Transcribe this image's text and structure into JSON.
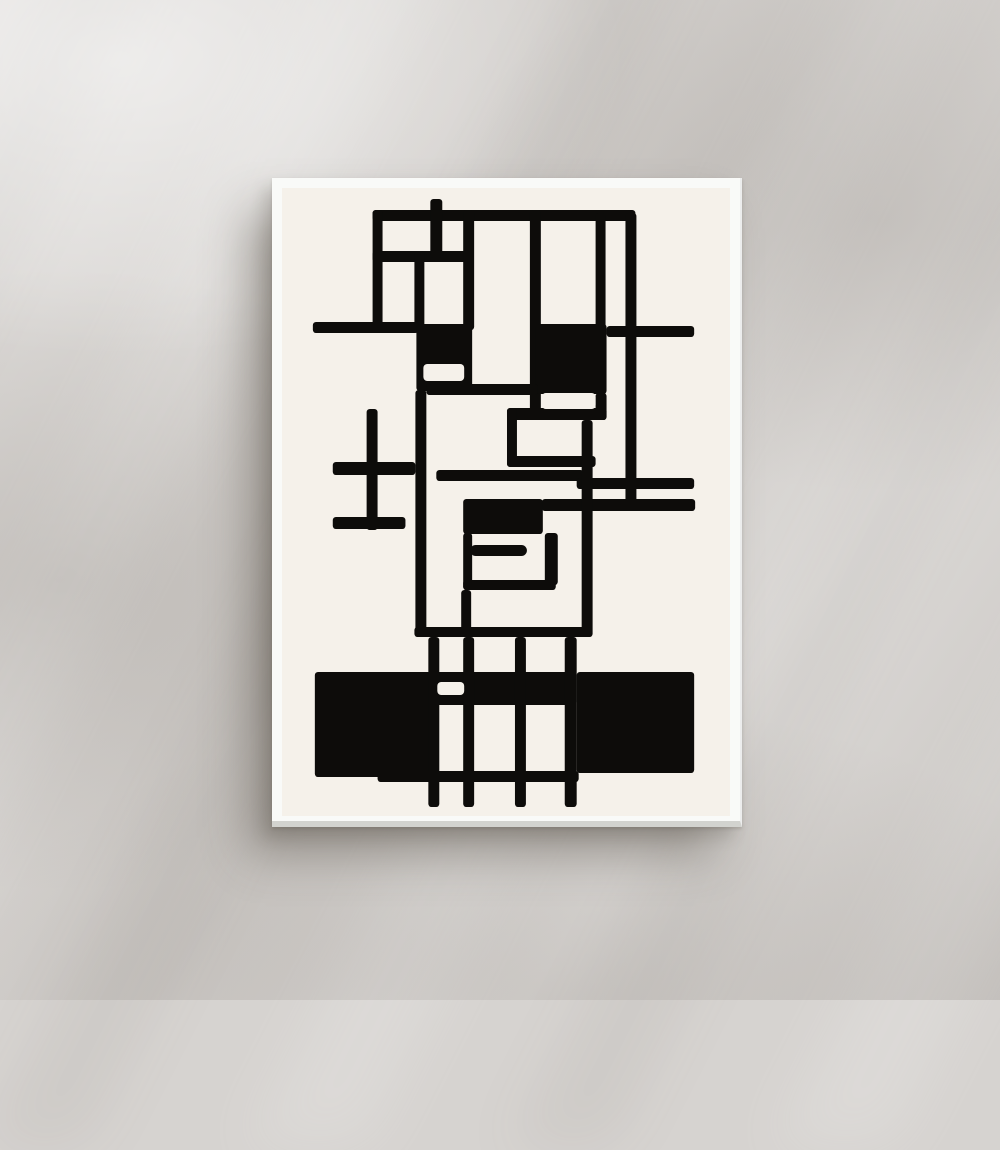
{
  "scene": {
    "description": "White framed poster with abstract black geometric line art on cream paper, hanging on a bright wall with soft diagonal window-light shadows",
    "colors": {
      "wall": "#d6d3d0",
      "wall_highlight": "#e7e5e2",
      "wall_shade": "#c7c3c0",
      "frame": "#f9faf8",
      "frame_edge": "#d2d3cf",
      "paper": "#f5f1ea",
      "ink": "#0d0c0a"
    }
  },
  "poster": {
    "left": 272,
    "top": 178,
    "width": 470,
    "height": 649,
    "paper_inset": 10
  },
  "artwork": {
    "title": "Abstract geometric black line composition on cream",
    "viewBox": "282 188 450 628",
    "line_radius": 3.2,
    "notch_radius": 4,
    "stub_radius": 5.5,
    "black_shapes": [
      [
        373,
        210,
        264,
        11
      ],
      [
        431,
        199,
        12,
        14
      ],
      [
        373,
        210,
        10,
        122
      ],
      [
        373,
        251,
        101,
        11
      ],
      [
        431,
        210,
        12,
        48
      ],
      [
        415,
        251,
        10,
        80
      ],
      [
        464,
        210,
        11,
        120
      ],
      [
        531,
        210,
        11,
        210
      ],
      [
        597,
        213,
        10,
        115
      ],
      [
        627,
        213,
        11,
        296
      ],
      [
        313,
        322,
        106,
        11
      ],
      [
        417,
        324,
        56,
        67
      ],
      [
        537,
        324,
        71,
        70
      ],
      [
        608,
        326,
        88,
        11
      ],
      [
        427,
        384,
        112,
        11
      ],
      [
        597,
        393,
        11,
        27
      ],
      [
        508,
        408,
        100,
        12
      ],
      [
        508,
        408,
        10,
        59
      ],
      [
        508,
        456,
        89,
        11
      ],
      [
        416,
        390,
        11,
        247
      ],
      [
        367,
        409,
        11,
        121
      ],
      [
        333,
        462,
        83,
        13
      ],
      [
        333,
        517,
        73,
        12
      ],
      [
        437,
        470,
        148,
        11
      ],
      [
        578,
        478,
        118,
        11
      ],
      [
        543,
        499,
        154,
        12
      ],
      [
        464,
        499,
        80,
        35
      ],
      [
        464,
        533,
        9,
        57
      ],
      [
        464,
        580,
        93,
        10
      ],
      [
        546,
        533,
        13,
        52
      ],
      [
        583,
        420,
        11,
        217
      ],
      [
        462,
        590,
        10,
        47
      ],
      [
        415,
        627,
        178,
        10
      ],
      [
        315,
        672,
        122,
        105
      ],
      [
        578,
        672,
        118,
        101
      ],
      [
        437,
        672,
        141,
        33
      ],
      [
        429,
        637,
        11,
        170
      ],
      [
        464,
        637,
        11,
        170
      ],
      [
        516,
        637,
        11,
        170
      ],
      [
        566,
        637,
        12,
        170
      ],
      [
        378,
        771,
        202,
        11
      ]
    ],
    "cream_notches": [
      [
        424,
        364,
        41,
        17
      ],
      [
        543,
        393,
        54,
        16
      ],
      [
        438,
        682,
        27,
        13
      ]
    ],
    "rounded_stub": [
      471,
      545,
      57,
      11
    ]
  }
}
